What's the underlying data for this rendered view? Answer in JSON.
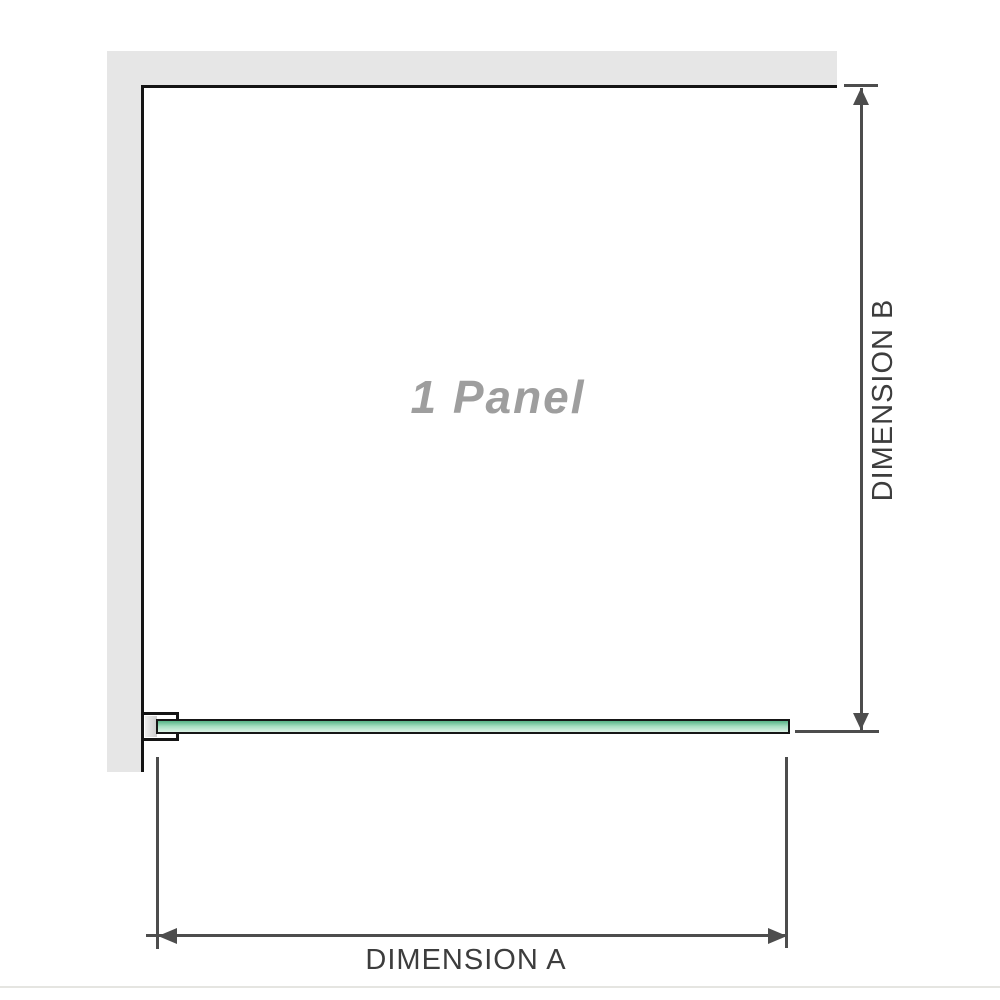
{
  "diagram": {
    "panel_label": "1 Panel",
    "dimensions": {
      "a": {
        "label": "DIMENSION A"
      },
      "b": {
        "label": "DIMENSION B"
      }
    }
  },
  "colors": {
    "wall": "#e6e6e6",
    "outline": "#141414",
    "dim": "#4d4d4d",
    "label": "#3d3d3d",
    "panel_text": "#9e9e9e",
    "glass_top": "#57b487",
    "glass_mid": "#a9e0c3",
    "glass_low": "#dcf2e6",
    "divider": "#e5e5e1"
  }
}
